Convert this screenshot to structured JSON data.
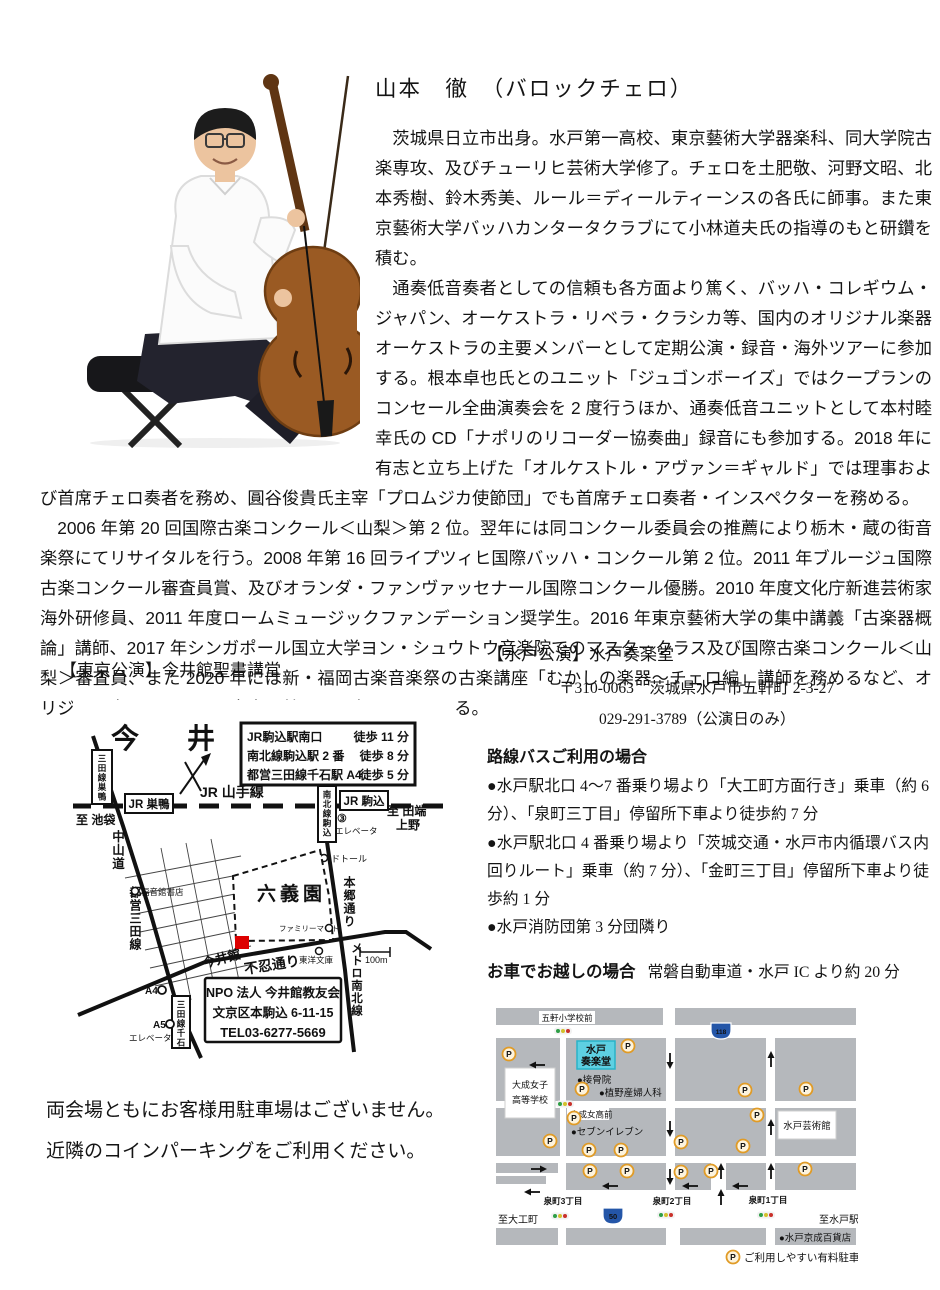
{
  "artist": {
    "title": "山本　徹　（バロックチェロ）"
  },
  "bio": {
    "paragraphs": [
      "茨城県日立市出身。水戸第一高校、東京藝術大学器楽科、同大学院古楽専攻、及びチューリヒ芸術大学修了。チェロを土肥敬、河野文昭、北本秀樹、鈴木秀美、ルール＝ディールティーンスの各氏に師事。また東京藝術大学バッハカンタータクラブにて小林道夫氏の指導のもと研鑽を積む。",
      "通奏低音奏者としての信頼も各方面より篤く、バッハ・コレギウム・ジャパン、オーケストラ・リベラ・クラシカ等、国内のオリジナル楽器オーケストラの主要メンバーとして定期公演・録音・海外ツアーに参加する。根本卓也氏とのユニット「ジュゴンボーイズ」ではクープランのコンセール全曲演奏会を 2 度行うほか、通奏低音ユニットとして本村睦幸氏の CD「ナポリのリコーダー協奏曲」録音にも参加する。2018 年に有志と立ち上げた「オルケストル・アヴァン＝ギャルド」では理事および首席チェロ奏者を務め、圓谷俊貴氏主宰「プロムジカ使節団」でも首席チェロ奏者・インスペクターを務める。",
      "2006 年第 20 回国際古楽コンクール＜山梨＞第 2 位。翌年には同コンクール委員会の推薦により栃木・蔵の街音楽祭にてリサイタルを行う。2008 年第 16 回ライプツィヒ国際バッハ・コンクール第 2 位。2011 年ブルージュ国際古楽コンクール審査員賞、及びオランダ・ファンヴァッセナール国際コンクール優勝。2010 年度文化庁新進芸術家海外研修員、2011 年度ロームミュージックファンデーション奨学生。2016 年東京藝術大学の集中講義「古楽器概論」講師、2017 年シンガポール国立大学ヨン・シュウトウ音楽院でのマスタークラス及び国際古楽コンクール＜山梨＞審査員、また 2020 年には新・福岡古楽音楽祭の古楽講座「むかしの楽器～チェロ編」講師を務めるなど、オリジナル楽器とバロック音楽の普及にも力を入れている。"
    ]
  },
  "tokyo": {
    "heading": "【東京公演】今井館聖書講堂",
    "map": {
      "title": "今　井　館",
      "access": [
        {
          "name": "JR駒込駅南口",
          "time": "徒歩 11 分"
        },
        {
          "name": "南北線駒込駅 2 番",
          "time": "徒歩 8 分"
        },
        {
          "name": "都営三田線千石駅 A4",
          "time": "徒歩 5 分"
        }
      ],
      "labels": {
        "yamanote": "JR 山手線",
        "jr_sugamo": "JR 巣鴨",
        "jr_komagome": "JR 駒込",
        "to_ikebukuro": "至 池袋",
        "to_tabata": "至 田端",
        "ueno": "上野",
        "mitasen_sugamo": "三田線巣鴨",
        "nakasendo": "中山道",
        "toei_mitasen": "都営三田線",
        "nanboku_komagome": "南北線駒込",
        "exit3": "③",
        "elevator": "エレベータ",
        "dotour": "ドトール",
        "hongo_dori": "本郷通り",
        "rikugien": "六義園",
        "familymart": "ファミリーマート",
        "fukuinkan": "福音館書店",
        "imaikan": "今井館",
        "shinobazu_dori": "不忍通り",
        "toyo_bunko": "東洋文庫",
        "metro_nanboku": "メトロ南北線",
        "scale": "100m",
        "a4": "A4",
        "a5": "A5",
        "elevator2": "エレベータ",
        "mitasen_sengoku": "三田線千石"
      },
      "npo": {
        "line1": "NPO 法人 今井館教友会",
        "line2": "文京区本駒込 6-11-15",
        "line3": "TEL03-6277-5669"
      }
    }
  },
  "mito": {
    "heading": "【水戸公演】水戸奏楽堂",
    "address": "〒310-0063　茨城県水戸市五軒町 2-3-27",
    "phone": "029-291-3789（公演日のみ）",
    "bus_heading": "路線バスご利用の場合",
    "bus_notes": [
      "●水戸駅北口 4～7 番乗り場より「大工町方面行き」乗車（約 6 分）、「泉町三丁目」停留所下車より徒歩約 7 分",
      "●水戸駅北口 4 番乗り場より「茨城交通・水戸市内循環バス内回りルート」乗車（約 7 分）、「金町三丁目」停留所下車より徒歩約 1 分",
      "●水戸消防団第 3 分団隣り"
    ],
    "car_heading": "お車でお越しの場合",
    "car_note": "常磐自動車道・水戸 IC より約 20 分",
    "map": {
      "bus_stop": "五軒小学校前",
      "venue1": "水戸",
      "venue2": "奏楽堂",
      "sekkotsuin": "●接骨院",
      "sanfujinka": "●植野産婦人科",
      "school1": "大成女子",
      "school2": "高等学校",
      "taisei_mae": "大成女高前",
      "seven_eleven": "●セブンイレブン",
      "art_tower": "水戸芸術館",
      "izumi3": "泉町3丁目",
      "izumi2": "泉町2丁目",
      "izumi1": "泉町1丁目",
      "to_daikumachi": "至大工町",
      "to_mito": "至水戸駅",
      "keisei": "●水戸京成百貨店",
      "legend": "ご利用しやすい有料駐車場",
      "parking_p": "P",
      "route50": "50",
      "route118": "118"
    }
  },
  "footer": {
    "line1": "両会場ともにお客様用駐車場はございません。",
    "line2": "近隣のコインパーキングをご利用ください。"
  },
  "colors": {
    "marker_red": "#dd0000",
    "venue_cyan": "#5ed0e2",
    "parking_orange": "#e09b26",
    "legend_navy": "#3b3b78",
    "block_gray": "#b5b8bc",
    "route_blue": "#2456a8"
  }
}
